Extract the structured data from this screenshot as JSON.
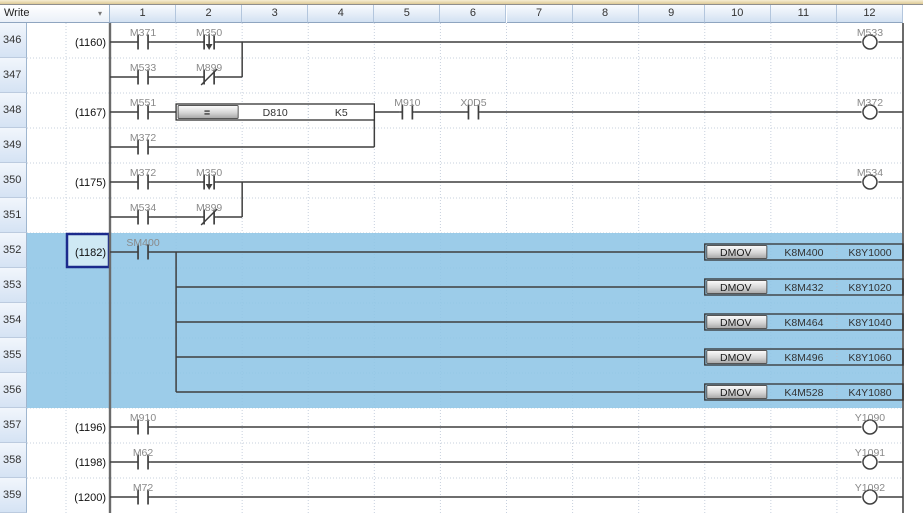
{
  "header": {
    "mode_label": "Write",
    "dropdown_icon": "▾",
    "columns": [
      "1",
      "2",
      "3",
      "4",
      "5",
      "6",
      "7",
      "8",
      "9",
      "10",
      "11",
      "12"
    ]
  },
  "rows": [
    {
      "num": "346",
      "step": "(1160)"
    },
    {
      "num": "347",
      "step": ""
    },
    {
      "num": "348",
      "step": "(1167)"
    },
    {
      "num": "349",
      "step": ""
    },
    {
      "num": "350",
      "step": "(1175)"
    },
    {
      "num": "351",
      "step": ""
    },
    {
      "num": "352",
      "step": "(1182)"
    },
    {
      "num": "353",
      "step": ""
    },
    {
      "num": "354",
      "step": ""
    },
    {
      "num": "355",
      "step": ""
    },
    {
      "num": "356",
      "step": ""
    },
    {
      "num": "357",
      "step": "(1196)"
    },
    {
      "num": "358",
      "step": "(1198)"
    },
    {
      "num": "359",
      "step": "(1200)"
    }
  ],
  "selection": {
    "first_row": "352",
    "last_row": "356",
    "cursor_row": "352"
  },
  "colors": {
    "highlight": "#8ec5e6",
    "highlight_blend": "#9acbe9",
    "cursor_border": "#1b2a8c",
    "cursor_fill": "#cfe9f4",
    "wire": "#3f3f3f",
    "rail": "#6b6b6b",
    "grid": "#c7d0de",
    "label": "#8a8a8a",
    "operand_text": "#333333",
    "step_text": "#111111"
  },
  "ladder": {
    "rungs": [
      {
        "row": "346",
        "wire": [
          0,
          12
        ],
        "contacts": [
          {
            "type": "no",
            "col": 1,
            "label": "M371"
          },
          {
            "type": "falling",
            "col": 2,
            "label": "M350"
          }
        ],
        "coil": {
          "col": 12,
          "label": "M533"
        }
      },
      {
        "row": "347",
        "wire": [
          0,
          2
        ],
        "contacts": [
          {
            "type": "no",
            "col": 1,
            "label": "M533"
          },
          {
            "type": "nc",
            "col": 2,
            "label": "M899"
          }
        ]
      },
      {
        "row": "348",
        "wire": [
          0,
          12
        ],
        "contacts": [
          {
            "type": "no",
            "col": 1,
            "label": "M551"
          },
          {
            "type": "no",
            "col": 5,
            "label": "M910"
          },
          {
            "type": "no",
            "col": 6,
            "label": "X0D5"
          }
        ],
        "block": {
          "start": 1,
          "button": "=",
          "operands": [
            "D810",
            "K5"
          ],
          "fill": "white"
        },
        "coil": {
          "col": 12,
          "label": "M372"
        }
      },
      {
        "row": "349",
        "wire": [
          0,
          4
        ],
        "contacts": [
          {
            "type": "no",
            "col": 1,
            "label": "M372"
          }
        ]
      },
      {
        "row": "350",
        "wire": [
          0,
          12
        ],
        "contacts": [
          {
            "type": "no",
            "col": 1,
            "label": "M372"
          },
          {
            "type": "falling",
            "col": 2,
            "label": "M350"
          }
        ],
        "coil": {
          "col": 12,
          "label": "M534"
        }
      },
      {
        "row": "351",
        "wire": [
          0,
          2
        ],
        "contacts": [
          {
            "type": "no",
            "col": 1,
            "label": "M534"
          },
          {
            "type": "nc",
            "col": 2,
            "label": "M899"
          }
        ]
      },
      {
        "row": "352",
        "wire": [
          0,
          9
        ],
        "contacts": [
          {
            "type": "no",
            "col": 1,
            "label": "SM400"
          }
        ],
        "block": {
          "start": 9,
          "button": "DMOV",
          "operands": [
            "K8M400",
            "K8Y1000"
          ],
          "fill": "none"
        }
      },
      {
        "row": "353",
        "wire": [
          1,
          9
        ],
        "block": {
          "start": 9,
          "button": "DMOV",
          "operands": [
            "K8M432",
            "K8Y1020"
          ],
          "fill": "none"
        }
      },
      {
        "row": "354",
        "wire": [
          1,
          9
        ],
        "block": {
          "start": 9,
          "button": "DMOV",
          "operands": [
            "K8M464",
            "K8Y1040"
          ],
          "fill": "none"
        }
      },
      {
        "row": "355",
        "wire": [
          1,
          9
        ],
        "block": {
          "start": 9,
          "button": "DMOV",
          "operands": [
            "K8M496",
            "K8Y1060"
          ],
          "fill": "none"
        }
      },
      {
        "row": "356",
        "wire": [
          1,
          9
        ],
        "block": {
          "start": 9,
          "button": "DMOV",
          "operands": [
            "K4M528",
            "K4Y1080"
          ],
          "fill": "none"
        }
      },
      {
        "row": "357",
        "wire": [
          0,
          12
        ],
        "contacts": [
          {
            "type": "no",
            "col": 1,
            "label": "M910"
          }
        ],
        "coil": {
          "col": 12,
          "label": "Y1090"
        }
      },
      {
        "row": "358",
        "wire": [
          0,
          12
        ],
        "contacts": [
          {
            "type": "no",
            "col": 1,
            "label": "M62"
          }
        ],
        "coil": {
          "col": 12,
          "label": "Y1091"
        }
      },
      {
        "row": "359",
        "wire": [
          0,
          12
        ],
        "contacts": [
          {
            "type": "no",
            "col": 1,
            "label": "M72"
          }
        ],
        "coil": {
          "col": 12,
          "label": "Y1092"
        }
      }
    ],
    "branches": [
      {
        "x": 2,
        "from": "346",
        "to": "347"
      },
      {
        "x": 4,
        "from": "348",
        "to": "349"
      },
      {
        "x": 2,
        "from": "350",
        "to": "351"
      },
      {
        "x": 1,
        "from": "352",
        "to": "356"
      }
    ]
  }
}
